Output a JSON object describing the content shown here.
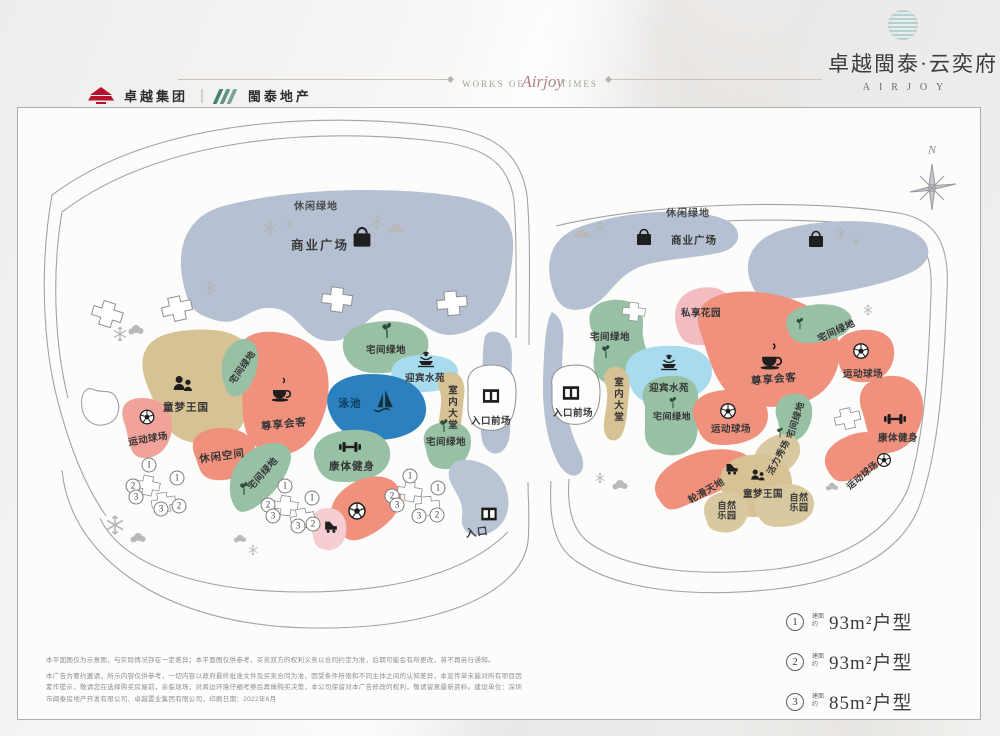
{
  "header": {
    "logo_left_primary": "卓越集团",
    "divider": "|",
    "logo_left_secondary": "閩泰地产",
    "tagline_prefix": "WORKS OF",
    "tagline_script": "Airjoy",
    "tagline_suffix": "TIMES",
    "project_title": "卓越閩泰·云奕府",
    "project_subtitle": "AIRJOY"
  },
  "compass": {
    "north": "N"
  },
  "terms": {
    "leisure_green": "休闲绿地",
    "commercial_plaza": "商业广场",
    "kids_kingdom": "童梦王国",
    "sports_court": "运动球场",
    "vip_lounge": "尊享会客",
    "home_green": "宅间绿地",
    "welcome_water": "迎宾水苑",
    "pool": "泳池",
    "indoor_lobby": "室内大堂",
    "entrance_plaza": "入口前场",
    "leisure_space": "休闲空间",
    "fitness": "康体健身",
    "entrance": "入口",
    "private_garden": "私享花园",
    "vitality_show": "活力秀场",
    "skating_world": "轮滑天地",
    "nature_park": "自然\n乐园"
  },
  "units": [
    "1",
    "2",
    "3",
    "1",
    "2",
    "3",
    "1",
    "2",
    "3",
    "1",
    "2",
    "3",
    "1",
    "2",
    "3",
    "1",
    "2",
    "3"
  ],
  "legend": {
    "items": [
      {
        "number": "1",
        "prefix": "建面约",
        "label": "93m²户型"
      },
      {
        "number": "2",
        "prefix": "建面约",
        "label": "93m²户型"
      },
      {
        "number": "3",
        "prefix": "建面约",
        "label": "85m²户型"
      }
    ]
  },
  "disclaimer": {
    "line1": "本平面图仅为示意图，与实际情况存在一定差异；本平面图仅供参考，买卖双方的权利义务以合同约定为准，后期可能会有所更改，将不再另行通知。",
    "line2": "本广告为要约邀请，所示内容仅供参考，一切内容以政府最终批准文件及买卖合同为准，因受条件所限和不同主体之间的认知差异，本宣传单未能对所有项目因素作提示，敬请您在选择购买房屋前，亲临现场，对周边环境仔细考察后再做购买决策，本公司保留对本广告修改的权利，敬请留意最新资料。建设单位：深圳市闽泰房地产开发有限公司、卓越置业集团有限公司，印刷日期：2022年6月"
  },
  "colors": {
    "road_blue": "#b5c1d3",
    "salmon": "#f0917d",
    "pink_light": "#f0a29b",
    "pink_soft": "#f3bcc1",
    "pink_pale": "#f6cdd1",
    "tan": "#d7c295",
    "green": "#97c0a5",
    "aqua": "#a9dbef",
    "pool_blue": "#2b80c0",
    "brand_red": "#b5122d",
    "brand_green": "#47816f"
  },
  "icons": {
    "shopping-bag-icon": "bag",
    "coffee-icon": "cup",
    "soccer-ball-icon": "ball",
    "children-icon": "people",
    "fountain-icon": "fountain",
    "sailboat-icon": "sail",
    "dumbbell-icon": "dumbbell",
    "sprout-icon": "leaf",
    "gate-icon": "door",
    "roller-skate-icon": "skate",
    "tree-icon": "snowflake",
    "compass-icon": "rose"
  }
}
